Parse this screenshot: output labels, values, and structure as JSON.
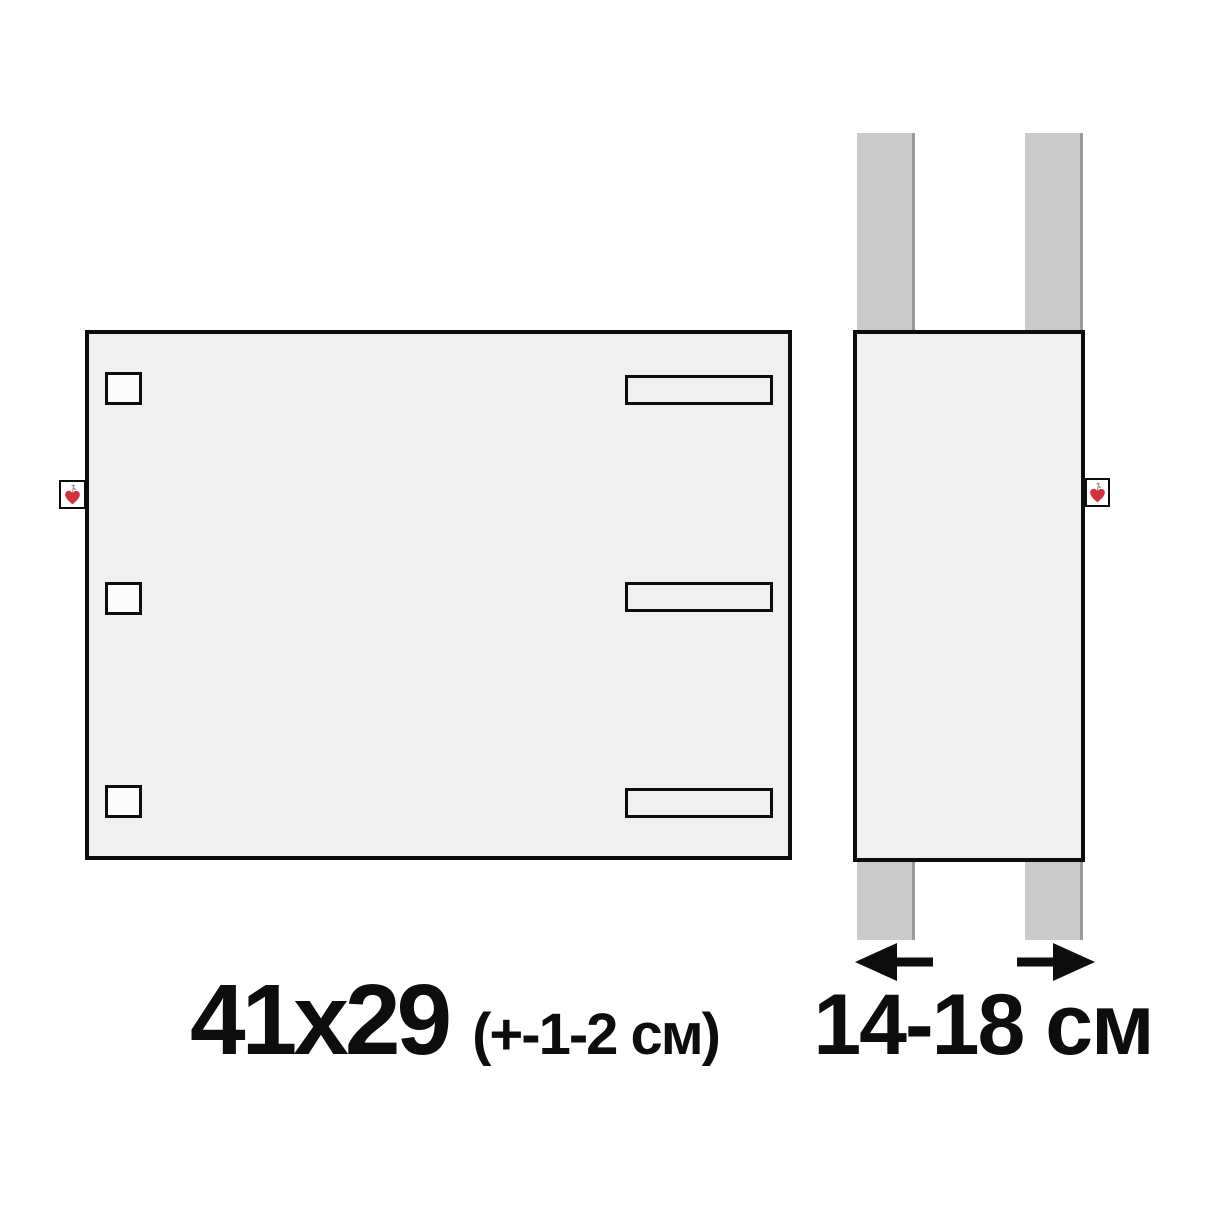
{
  "labels": {
    "front_size": "41x29",
    "front_tolerance": "(+-1-2 см)",
    "strap_range": "14-18 см"
  },
  "diagram": {
    "front_panel": {
      "button_holes": 3,
      "strap_slots": 3,
      "brand_tag": "heart-sprout"
    },
    "side_panel": {
      "straps": 2,
      "brand_tag": "heart-sprout"
    },
    "arrows": [
      "left",
      "right"
    ]
  },
  "colors": {
    "background": "#ffffff",
    "panel_fill": "#f0f0f0",
    "outline": "#0d0d0d",
    "strap_fill": "#cbcbcb",
    "strap_shadow": "#9a9a9a",
    "tag_fill": "#ffffff",
    "heart": "#d2323e",
    "stem": "#8a8a8a",
    "text": "#0d0d0d"
  }
}
